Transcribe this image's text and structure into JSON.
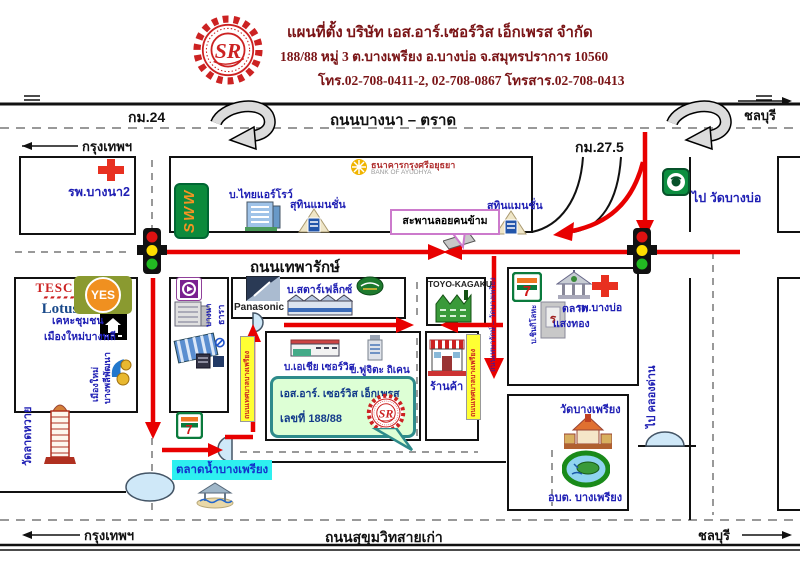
{
  "header": {
    "title": "แผนที่ตั้ง บริษัท เอส.อาร์.เซอร์วิส เอ็กเพรส จำกัด",
    "address": "188/88  หมู่ 3  ต.บางเพรียง  อ.บางบ่อ  จ.สมุทรปราการ  10560",
    "phone": "โทร.02-708-0411-2, 02-708-0867   โทรสาร.02-708-0413",
    "logo_text": "SR"
  },
  "highway_top": {
    "name": "ถนนบางนา – ตราด",
    "km_left": "กม.24",
    "km_right": "กม.27.5",
    "dest_left": "กรุงเทพฯ",
    "dest_right": "ชลบุรี"
  },
  "highway_bottom": {
    "name": "ถนนสุขุมวิทสายเก่า",
    "dest_left": "กรุงเทพฯ",
    "dest_right": "ชลบุรี"
  },
  "roads": {
    "thepharak": "ถนนเทพารักษ์",
    "to_wat_bangbo": "ไป วัดบางบ่อ",
    "to_khlong_dan": "ไป คลองด่าน",
    "soi_company": "ถนนเทพารักษ์ – วัดบางเพรียง",
    "side_road_label": "ถนนเทศบาลบางเพรียง"
  },
  "landmarks": {
    "hospital_bangna": "รพ.บางนา2",
    "sww": "SWW",
    "thai_arrow": "บ.ไทยแอร์โรว์",
    "suthin_mansion": "สุทินแมนชั่น",
    "bank_line1": "ธนาคารกรุงศรีอยุธยา",
    "bank_line2": "BANK OF AYUDHYA",
    "footbridge": "สะพานลอยคนข้าม",
    "tesco": "TESCO",
    "lotus": "Lotus",
    "yes": "YES",
    "khehachumchon_1": "เคหะชุมชน",
    "khehachumchon_2": "เมืองใหม่บางพลี",
    "muangmai_1": "เมืองใหม่",
    "muangmai_2": "บางพลีพัฒนา",
    "wat_ladhwai": "วัดลาดหวาย",
    "panasonic": "Panasonic",
    "starflex": "บ.สตาร์เฟล็กซ์",
    "toyo": "TOYO-KAGAKU",
    "village_v1": "บางนา",
    "village_v2": "ธารา",
    "asia_service": "บ.เอเชีย เซอร์วิส",
    "fujita": "บ.ฟูจิตะ ถิเคน",
    "shop": "ร้านค้า",
    "seven": "7",
    "shinki": "บ.ชินกิโลหะ",
    "sangthong_1": "ตลาด",
    "sangthong_2": "แสงทอง",
    "hospital_bangbo": "รพ.บางบ่อ",
    "wat_bangphriang": "วัดบางเพรียง",
    "obt": "อบต. บางเพรียง",
    "floating_market": "ตลาดน้ำบางเพรียง"
  },
  "company_callout": {
    "line1": "เอส.อาร์. เซอร์วิส เอ็กเพรส",
    "line2": "เลขที่ 188/88"
  },
  "colors": {
    "route_red": "#e80000",
    "label_blue": "#1f1fb4",
    "title_maroon": "#7a1416",
    "highlight_cyan": "#2ef0f0",
    "highlight_yellow": "#ffff33"
  }
}
